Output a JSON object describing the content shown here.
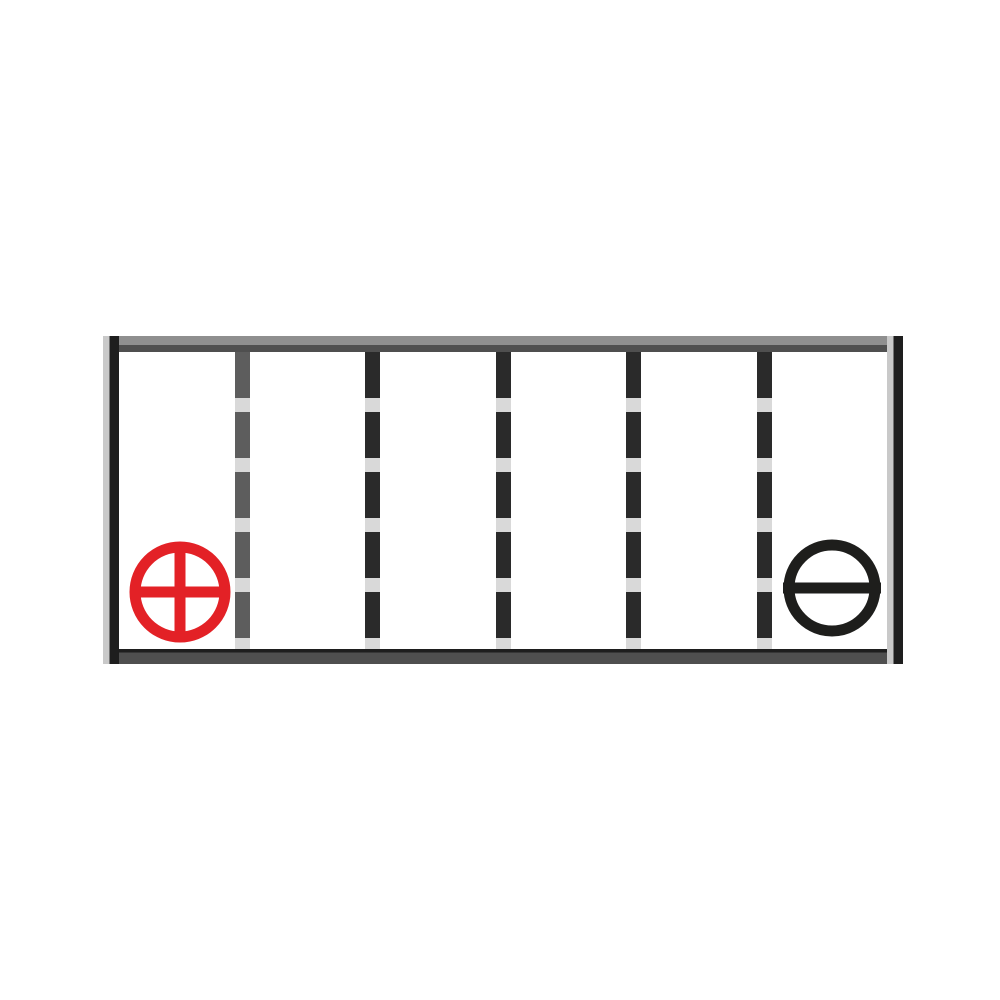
{
  "diagram": {
    "title": "6-cell battery top view schematic",
    "type": "battery-schematic",
    "background_color": "#ffffff",
    "battery": {
      "cells": {
        "count": 6,
        "divider_count": 5,
        "divider_style": "dashed",
        "divider_tones": [
          "gray",
          "dark",
          "dark",
          "dark",
          "dark"
        ]
      },
      "terminals": {
        "positive": {
          "symbol": "⊕",
          "name": "positive terminal",
          "position": "bottom-left",
          "color": "#e32126"
        },
        "negative": {
          "symbol": "⊖",
          "name": "negative terminal",
          "position": "bottom-right",
          "color": "#1e1e1c"
        }
      },
      "colors": {
        "frame_gray_light": "#8f8f8f",
        "frame_gray_dark": "#4f4f4f",
        "frame_black": "#1e1e1e",
        "frame_halo": "#c9c9c9",
        "divider_dark": "#2a2a2a",
        "divider_gray": "#5d5d5d",
        "divider_gap": "#d9d9d9"
      }
    }
  }
}
